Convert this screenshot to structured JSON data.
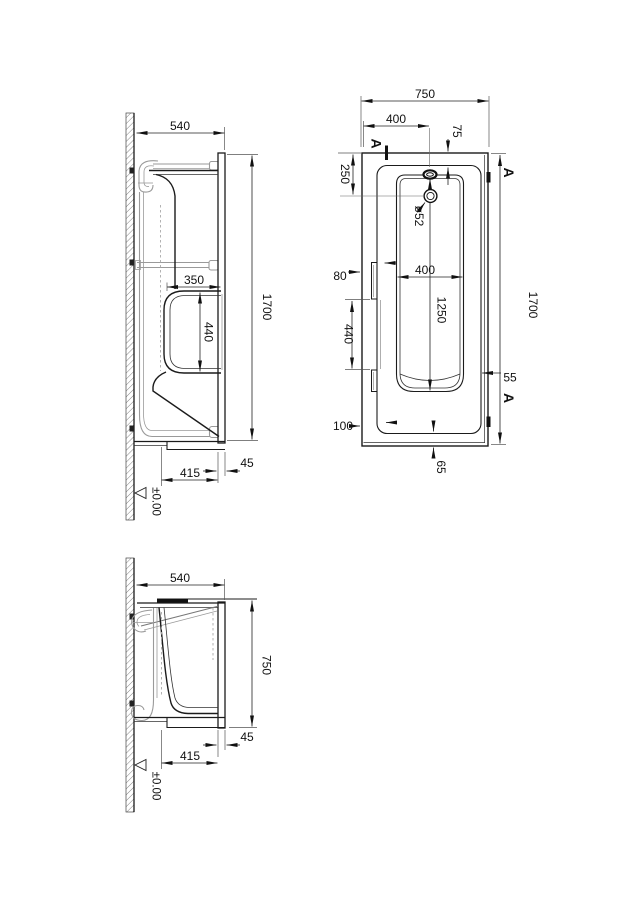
{
  "drawing_title": "bathtub technical installation drawing",
  "colors": {
    "line": "#1b1b1b",
    "dim": "#222222",
    "frame": "#9a9a9a",
    "background": "#ffffff"
  },
  "v1": {
    "width": "540",
    "recess_width": "350",
    "recess_height": "440",
    "length": "1700",
    "apron": "45",
    "base": "415",
    "level": "±0.00"
  },
  "plan": {
    "width": "750",
    "centerline_offset": "400",
    "rim_top": "75",
    "drain_offset": "250",
    "drain_dia": "ø52",
    "edge_gap": "80",
    "well_width": "400",
    "well_length": "1250",
    "bracket_span": "440",
    "length": "1700",
    "rim_right": "55",
    "corner_gap": "100",
    "rim_foot": "65",
    "section": "A"
  },
  "v2": {
    "width": "540",
    "height": "750",
    "apron": "45",
    "base": "415",
    "level": "±0.00"
  }
}
